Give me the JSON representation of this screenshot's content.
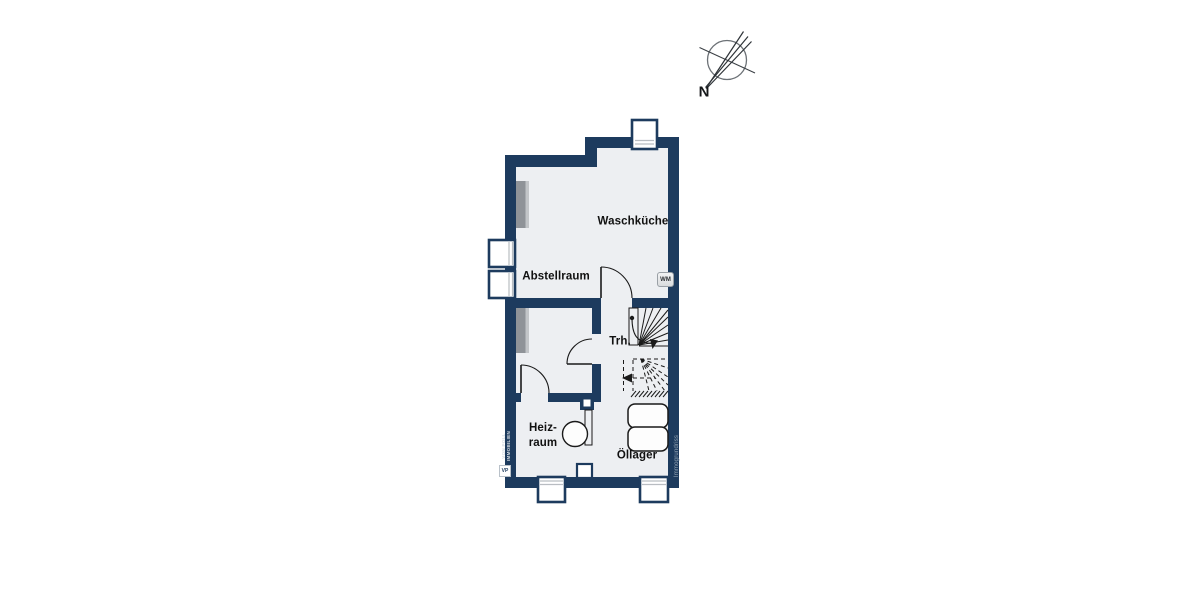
{
  "colors": {
    "wall": "#1d3b5e",
    "floor": "#edeff2",
    "line": "#1a1a1a"
  },
  "compass": {
    "label": "N"
  },
  "rooms": {
    "waschkueche": {
      "label": "Waschküche"
    },
    "abstellraum": {
      "label": "Abstellraum"
    },
    "treppenhaus": {
      "label": "Trh."
    },
    "heizraum": {
      "label_line1": "Heiz-",
      "label_line2": "raum"
    },
    "oellager": {
      "label": "Öllager"
    }
  },
  "appliances": {
    "washing_machine_label": "WM"
  },
  "watermarks": {
    "left_line1": "VON POLL",
    "left_line2": "IMMOBILIEN",
    "left_logo": "VP",
    "right": "Immogrundriss"
  }
}
